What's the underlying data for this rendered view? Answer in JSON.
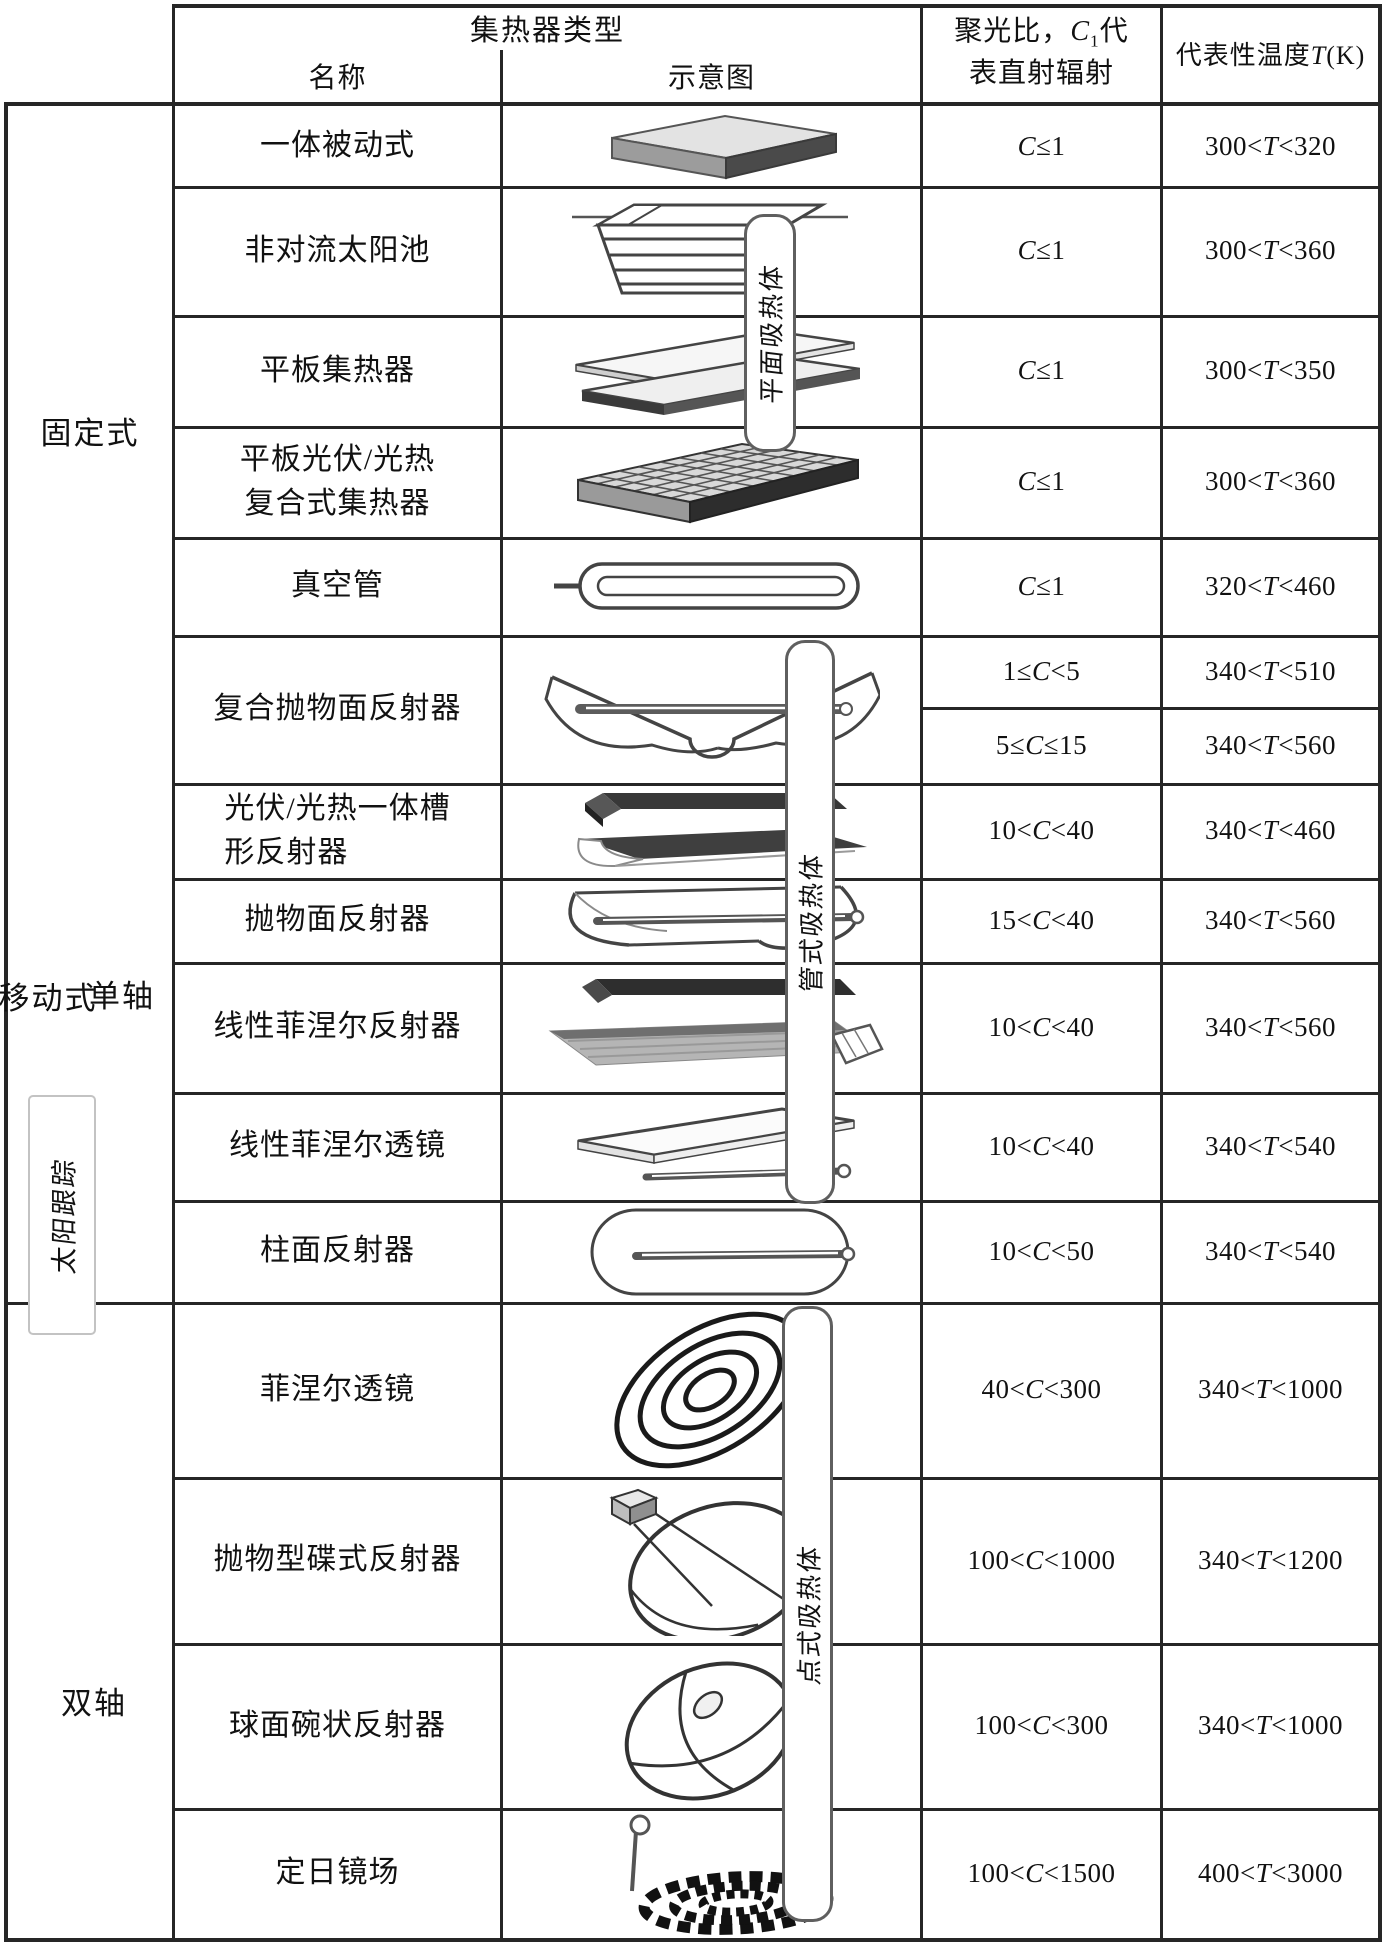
{
  "header": {
    "group_title": "集热器类型",
    "col_name": "名称",
    "col_schematic": "示意图",
    "concentration_line1": "聚光比，C1代",
    "concentration_line2": "表直射辐射",
    "col_temperature": "代表性温度T(K)"
  },
  "categories": {
    "fixed": "固定式",
    "movable": "移动式",
    "single_axis": "单轴",
    "dual_axis": "双轴",
    "sun_tracking": "太阳跟踪"
  },
  "absorber_labels": {
    "flat": "平面吸热体",
    "tube": "管式吸热体",
    "point": "点式吸热体"
  },
  "rows": [
    {
      "name": "一体被动式",
      "schematic": "integrated-passive-slab",
      "conc": "C≤1",
      "temp": "300<T<320"
    },
    {
      "name": "非对流太阳池",
      "schematic": "non-convective-solar-pond",
      "conc": "C≤1",
      "temp": "300<T<360"
    },
    {
      "name": "平板集热器",
      "schematic": "flat-plate-collector",
      "conc": "C≤1",
      "temp": "300<T<350"
    },
    {
      "name": "平板光伏/光热\n复合式集热器",
      "schematic": "flat-pvt-hybrid-collector",
      "conc": "C≤1",
      "temp": "300<T<360"
    },
    {
      "name": "真空管",
      "schematic": "evacuated-tube",
      "conc": "C≤1",
      "temp": "320<T<460"
    },
    {
      "name": "复合抛物面反射器",
      "schematic": "compound-parabolic-reflector",
      "sub": [
        {
          "conc": "1≤C<5",
          "temp": "340<T<510"
        },
        {
          "conc": "5≤C≤15",
          "temp": "340<T<560"
        }
      ]
    },
    {
      "name": "光伏/光热一体槽\n形反射器",
      "schematic": "pvt-trough-reflector",
      "conc": "10<C<40",
      "temp": "340<T<460"
    },
    {
      "name": "抛物面反射器",
      "schematic": "parabolic-trough-reflector",
      "conc": "15<C<40",
      "temp": "340<T<560"
    },
    {
      "name": "线性菲涅尔反射器",
      "schematic": "linear-fresnel-reflector",
      "conc": "10<C<40",
      "temp": "340<T<560"
    },
    {
      "name": "线性菲涅尔透镜",
      "schematic": "linear-fresnel-lens",
      "conc": "10<C<40",
      "temp": "340<T<540"
    },
    {
      "name": "柱面反射器",
      "schematic": "cylindrical-reflector",
      "conc": "10<C<50",
      "temp": "340<T<540"
    },
    {
      "name": "菲涅尔透镜",
      "schematic": "fresnel-lens",
      "conc": "40<C<300",
      "temp": "340<T<1000"
    },
    {
      "name": "抛物型碟式反射器",
      "schematic": "parabolic-dish-reflector",
      "conc": "100<C<1000",
      "temp": "340<T<1200"
    },
    {
      "name": "球面碗状反射器",
      "schematic": "spherical-bowl-reflector",
      "conc": "100<C<300",
      "temp": "340<T<1000"
    },
    {
      "name": "定日镜场",
      "schematic": "heliostat-field",
      "conc": "100<C<1500",
      "temp": "400<T<3000"
    }
  ]
}
